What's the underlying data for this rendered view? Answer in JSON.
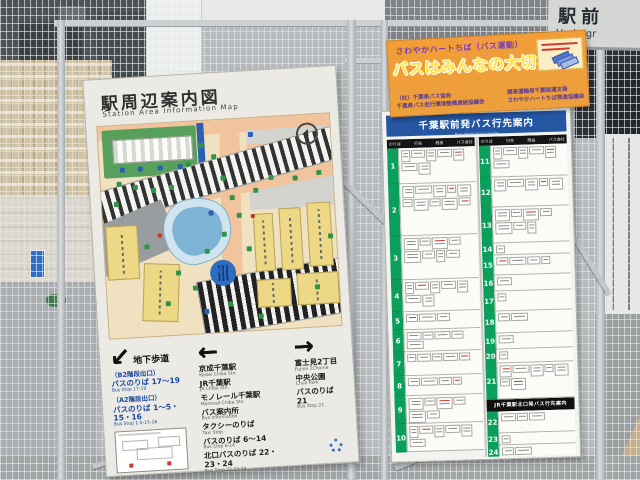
{
  "overhead_sign": {
    "ja": "駅前",
    "en": "Undergr"
  },
  "map_sign": {
    "title_ja": "駅周辺案内図",
    "title_en": "Station  Area  Information  Map",
    "directions": {
      "col1": {
        "arrow": "↙",
        "heading": "地下歩道",
        "items": [
          {
            "ja": "（B2階段出口）",
            "en": ""
          },
          {
            "ja": "バスのりば 17～19",
            "en": "Bus Stop 17-19"
          },
          {
            "ja": "（A2階段出口）",
            "en": ""
          },
          {
            "ja": "バスのりば 1～5・15・16",
            "en": "Bus Stop 1-5-15-16"
          }
        ]
      },
      "col2": {
        "arrow": "←",
        "items": [
          {
            "ja": "京成千葉駅",
            "en": "Keisei Chiba Stn."
          },
          {
            "ja": "JR千葉駅",
            "en": "JR Chiba Stn."
          },
          {
            "ja": "モノレール千葉駅",
            "en": "Monorail Chiba Stn."
          },
          {
            "ja": "バス案内所",
            "en": "Bus Information"
          },
          {
            "ja": "タクシーのりば",
            "en": "Taxi Stop"
          },
          {
            "ja": "バスのりば 6～14",
            "en": "Bus Stop 6-14"
          },
          {
            "ja": "北口バスのりば 22・23・24",
            "en": "Bus Stop 22-23-24"
          }
        ]
      },
      "col3": {
        "arrow": "→",
        "items": [
          {
            "ja": "富士見2丁目",
            "en": "Fujimi 2Chome"
          },
          {
            "ja": "中央公園",
            "en": "Chuo Park"
          },
          {
            "ja": "バスのりば 21",
            "en": "Bus Stop 21"
          }
        ]
      }
    }
  },
  "campaign_banner": {
    "tagline": "さわやかハートちば（バス運動）",
    "headline": "バスはみんなの大切な足",
    "heart": "♡",
    "org_left_1": "（社）千葉県バス協会",
    "org_left_2": "千葉県バス走行環境整備連絡協議会",
    "org_right_1": "関東運輸局千葉陸運支局",
    "org_right_2": "さわやかハートちば推進協議会"
  },
  "bus_board": {
    "title_ja": "千葉駅前発バス行先案内",
    "title_en": "Bus destination guide",
    "columns": [
      "のりば",
      "行先",
      "経由",
      "バス会社"
    ],
    "north_exit_banner": "JR千葉駅北口発バス行先案内",
    "left_stops": [
      "1",
      "2",
      "3",
      "4",
      "5",
      "6",
      "7",
      "8",
      "9",
      "10"
    ],
    "right_stops": [
      "11",
      "12",
      "13",
      "14",
      "15",
      "16",
      "17",
      "18",
      "19",
      "20",
      "21",
      "22",
      "23",
      "24"
    ]
  },
  "colors": {
    "board_blue": "#2456a2",
    "stop_green": "#0aa05c",
    "banner_orange": "#f09a34",
    "headline_yellow": "#ffe43d",
    "tagline_purple": "#7a3fae",
    "map_cream": "#f0e1c1",
    "map_road_peach": "#f2c49e",
    "map_water_blue": "#7db4d6"
  }
}
